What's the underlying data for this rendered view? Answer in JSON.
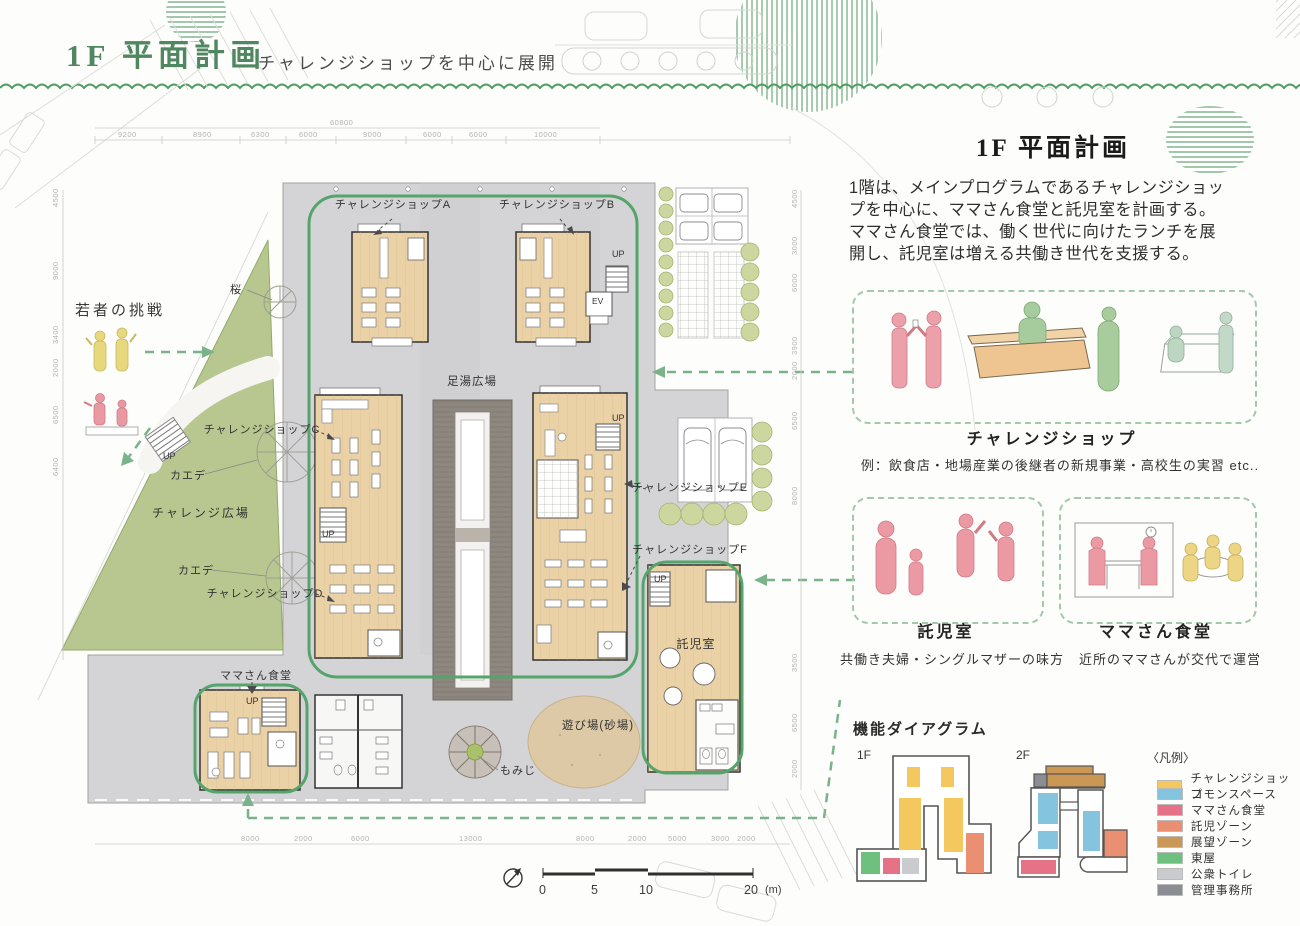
{
  "colors": {
    "title_green": "#4e8760",
    "accent_green": "#55a46c",
    "dashed_green": "#7ab389",
    "lawn": "#b7c78f",
    "paving": "#d4d4d6",
    "wood": "#ead2a6",
    "sand": "#ddc9a6"
  },
  "header": {
    "title": "1F 平面計画",
    "subtitle": "チャレンジショップを中心に展開"
  },
  "overview": {
    "title": "1F 平面計画",
    "lines": [
      "1階は、メインプログラムであるチャレンジショッ",
      "プを中心に、ママさん食堂と託児室を計画する。",
      "ママさん食堂では、働く世代に向けたランチを展",
      "開し、託児室は増える共働き世代を支援する。"
    ]
  },
  "cards": {
    "challenge_shop": {
      "title": "チャレンジショップ",
      "note": "例：飲食店・地場産業の後継者の新規事業・高校生の実習 etc.."
    },
    "nursery": {
      "title": "託児室",
      "note": "共働き夫婦・シングルマザーの味方"
    },
    "mama_dining": {
      "title": "ママさん食堂",
      "note": "近所のママさんが交代で運営"
    }
  },
  "plan": {
    "labels": {
      "shop_a": "チャレンジショップA",
      "shop_b": "チャレンジショップB",
      "shop_c": "チャレンジショップC",
      "shop_d": "チャレンジショップD",
      "shop_e": "チャレンジショップE",
      "shop_f": "チャレンジショップF",
      "ashiyu_plaza": "足湯広場",
      "challenge_plaza": "チャレンジ広場",
      "nursery": "託児室",
      "mama_dining": "ママさん食堂",
      "playground": "遊び場(砂場)",
      "momiji": "もみじ",
      "kaede": "カエデ",
      "sakura": "桜",
      "youth_challenge": "若者の挑戦",
      "up": "UP",
      "ev": "EV"
    },
    "scale": {
      "n0": "0",
      "n5": "5",
      "n10": "10",
      "n20": "20",
      "unit": "(m)"
    },
    "dims": {
      "top_total": "60800",
      "top": [
        "9200",
        "8900",
        "6300",
        "6000",
        "9000",
        "6000",
        "6000",
        "10000"
      ],
      "left": [
        "4500",
        "9000",
        "3400",
        "2000",
        "6500",
        "6400"
      ],
      "right": [
        "4500",
        "3000",
        "6000",
        "3900",
        "2000",
        "6500",
        "8000",
        "3500",
        "6500",
        "2000"
      ],
      "bottom": [
        "8000",
        "2000",
        "6000",
        "13000",
        "8000",
        "2000",
        "5000",
        "3000",
        "2000"
      ]
    }
  },
  "diagram": {
    "title": "機能ダイアグラム",
    "floor1": "1F",
    "floor2": "2F",
    "legend_title": "〈凡例〉",
    "legend": [
      {
        "label": "チャレンジショップ",
        "color": "#f4c85f"
      },
      {
        "label": "コモンスペース",
        "color": "#85c4de"
      },
      {
        "label": "ママさん食堂",
        "color": "#e57286"
      },
      {
        "label": "託児ゾーン",
        "color": "#eb8f72"
      },
      {
        "label": "展望ゾーン",
        "color": "#cb9755"
      },
      {
        "label": "東屋",
        "color": "#6dc07e"
      },
      {
        "label": "公衆トイレ",
        "color": "#c9cbcf"
      },
      {
        "label": "管理事務所",
        "color": "#8a8e93"
      }
    ]
  }
}
